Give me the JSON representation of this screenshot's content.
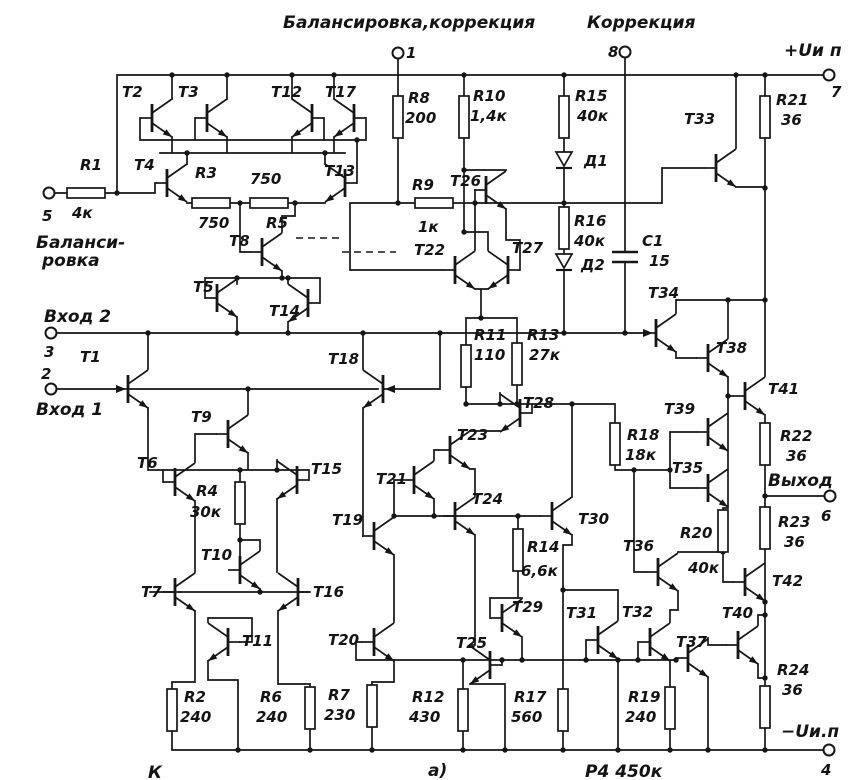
{
  "captions": {
    "left": "К",
    "center": "а)",
    "right": "Р4 450к"
  },
  "terminals": [
    {
      "pin": "1",
      "name": "Балансировка,коррекция",
      "cx": 398,
      "cy": 53,
      "numx": 406,
      "numy": 58,
      "namex": 283,
      "namey": 28
    },
    {
      "pin": "8",
      "name": "Коррекция",
      "cx": 625,
      "cy": 52,
      "numx": 608,
      "numy": 57,
      "namex": 587,
      "namey": 28
    },
    {
      "pin": "7",
      "name": "+Uи п",
      "cx": 829,
      "cy": 75,
      "numx": 831,
      "numy": 97,
      "namex": 784,
      "namey": 56
    },
    {
      "pin": "5",
      "name": "Балансировка",
      "lines": [
        "Баланси-",
        "ровка"
      ],
      "cx": 49,
      "cy": 193,
      "numx": 42,
      "numy": 221,
      "namex": 36,
      "namey": 248,
      "l2x": 42,
      "l2y": 266
    },
    {
      "pin": "3",
      "name": "Вход 2",
      "cx": 51,
      "cy": 333,
      "numx": 44,
      "numy": 357,
      "namex": 44,
      "namey": 322
    },
    {
      "pin": "2",
      "name": "Вход 1",
      "cx": 51,
      "cy": 389,
      "numx": 41,
      "numy": 379,
      "namex": 36,
      "namey": 415
    },
    {
      "pin": "6",
      "name": "Выход",
      "cx": 830,
      "cy": 496,
      "numx": 821,
      "numy": 521,
      "namex": 768,
      "namey": 486
    },
    {
      "pin": "4",
      "name": "−Uи.п",
      "cx": 829,
      "cy": 750,
      "numx": 821,
      "numy": 775,
      "namex": 781,
      "namey": 737
    }
  ],
  "transistors": [
    {
      "name": "T1",
      "x": 128,
      "y": 389,
      "dir": "R",
      "lx": 80,
      "ly": 362
    },
    {
      "name": "T2",
      "x": 152,
      "y": 118,
      "dir": "R",
      "lx": 122,
      "ly": 97
    },
    {
      "name": "T3",
      "x": 207,
      "y": 118,
      "dir": "R",
      "lx": 178,
      "ly": 97
    },
    {
      "name": "T4",
      "x": 167,
      "y": 183,
      "dir": "R",
      "lx": 134,
      "ly": 170
    },
    {
      "name": "T5",
      "x": 217,
      "y": 298,
      "dir": "R",
      "lx": 193,
      "ly": 292
    },
    {
      "name": "T6",
      "x": 175,
      "y": 482,
      "dir": "R",
      "lx": 137,
      "ly": 468
    },
    {
      "name": "T7",
      "x": 175,
      "y": 592,
      "dir": "R",
      "lx": 141,
      "ly": 597
    },
    {
      "name": "T8",
      "x": 262,
      "y": 252,
      "dir": "R",
      "lx": 229,
      "ly": 246
    },
    {
      "name": "T9",
      "x": 228,
      "y": 434,
      "dir": "R",
      "lx": 191,
      "ly": 422
    },
    {
      "name": "T10",
      "x": 240,
      "y": 570,
      "dir": "R",
      "lx": 201,
      "ly": 560
    },
    {
      "name": "T11",
      "x": 228,
      "y": 642,
      "dir": "L",
      "lx": 242,
      "ly": 646
    },
    {
      "name": "T12",
      "x": 312,
      "y": 118,
      "dir": "L",
      "lx": 271,
      "ly": 97
    },
    {
      "name": "T13",
      "x": 345,
      "y": 183,
      "dir": "L",
      "lx": 324,
      "ly": 176
    },
    {
      "name": "T14",
      "x": 308,
      "y": 303,
      "dir": "L",
      "lx": 269,
      "ly": 316
    },
    {
      "name": "T15",
      "x": 297,
      "y": 480,
      "dir": "L",
      "lx": 311,
      "ly": 474
    },
    {
      "name": "T16",
      "x": 298,
      "y": 592,
      "dir": "L",
      "lx": 313,
      "ly": 597
    },
    {
      "name": "T17",
      "x": 354,
      "y": 118,
      "dir": "L",
      "lx": 325,
      "ly": 97
    },
    {
      "name": "T18",
      "x": 383,
      "y": 389,
      "dir": "L",
      "lx": 328,
      "ly": 364
    },
    {
      "name": "T19",
      "x": 374,
      "y": 536,
      "dir": "R",
      "lx": 332,
      "ly": 525
    },
    {
      "name": "T20",
      "x": 374,
      "y": 642,
      "dir": "R",
      "lx": 328,
      "ly": 645
    },
    {
      "name": "T21",
      "x": 414,
      "y": 480,
      "dir": "R",
      "lx": 376,
      "ly": 484
    },
    {
      "name": "T22",
      "x": 455,
      "y": 270,
      "dir": "R",
      "lx": 414,
      "ly": 255
    },
    {
      "name": "T23",
      "x": 450,
      "y": 450,
      "dir": "R",
      "lx": 457,
      "ly": 440
    },
    {
      "name": "T24",
      "x": 455,
      "y": 516,
      "dir": "R",
      "lx": 472,
      "ly": 504
    },
    {
      "name": "T25",
      "x": 490,
      "y": 665,
      "dir": "L",
      "lx": 456,
      "ly": 648
    },
    {
      "name": "T26",
      "x": 486,
      "y": 190,
      "dir": "R",
      "lx": 450,
      "ly": 186
    },
    {
      "name": "T27",
      "x": 508,
      "y": 270,
      "dir": "L",
      "lx": 512,
      "ly": 253
    },
    {
      "name": "T28",
      "x": 520,
      "y": 413,
      "dir": "L",
      "lx": 523,
      "ly": 408
    },
    {
      "name": "T29",
      "x": 502,
      "y": 618,
      "dir": "R",
      "lx": 512,
      "ly": 612
    },
    {
      "name": "T30",
      "x": 552,
      "y": 516,
      "dir": "R",
      "lx": 578,
      "ly": 524
    },
    {
      "name": "T31",
      "x": 598,
      "y": 640,
      "dir": "R",
      "lx": 566,
      "ly": 618
    },
    {
      "name": "T32",
      "x": 650,
      "y": 642,
      "dir": "R",
      "lx": 622,
      "ly": 617
    },
    {
      "name": "T33",
      "x": 716,
      "y": 168,
      "dir": "R",
      "lx": 684,
      "ly": 124
    },
    {
      "name": "T34",
      "x": 656,
      "y": 333,
      "dir": "R",
      "lx": 648,
      "ly": 298
    },
    {
      "name": "T35",
      "x": 708,
      "y": 488,
      "dir": "R",
      "lx": 672,
      "ly": 473
    },
    {
      "name": "T36",
      "x": 658,
      "y": 572,
      "dir": "R",
      "lx": 623,
      "ly": 551
    },
    {
      "name": "T37",
      "x": 688,
      "y": 658,
      "dir": "R",
      "lx": 676,
      "ly": 647
    },
    {
      "name": "T38",
      "x": 708,
      "y": 358,
      "dir": "R",
      "lx": 716,
      "ly": 353
    },
    {
      "name": "T39",
      "x": 708,
      "y": 432,
      "dir": "R",
      "lx": 664,
      "ly": 414
    },
    {
      "name": "T40",
      "x": 738,
      "y": 645,
      "dir": "R",
      "lx": 722,
      "ly": 618
    },
    {
      "name": "T41",
      "x": 745,
      "y": 396,
      "dir": "R",
      "lx": 768,
      "ly": 394
    },
    {
      "name": "T42",
      "x": 745,
      "y": 582,
      "dir": "R",
      "lx": 772,
      "ly": 586
    }
  ],
  "resistors": [
    {
      "name": "R1",
      "value": "4к",
      "x": 86,
      "y": 193,
      "orient": "h",
      "nx": 80,
      "ny": 170,
      "vx": 72,
      "vy": 218
    },
    {
      "name": "R2",
      "value": "240",
      "x": 172,
      "y": 710,
      "orient": "v",
      "nx": 184,
      "ny": 702,
      "vx": 180,
      "vy": 722
    },
    {
      "name": "R3",
      "value": "750",
      "x": 211,
      "y": 203,
      "orient": "h",
      "nx": 195,
      "ny": 178,
      "vx": 198,
      "vy": 228
    },
    {
      "name": "R4",
      "value": "30к",
      "x": 240,
      "y": 503,
      "orient": "v",
      "nx": 196,
      "ny": 496,
      "vx": 190,
      "vy": 517
    },
    {
      "name": "R5",
      "value": "750",
      "x": 269,
      "y": 203,
      "orient": "h",
      "nx": 266,
      "ny": 228,
      "vx": 250,
      "vy": 184
    },
    {
      "name": "R6",
      "value": "240",
      "x": 310,
      "y": 708,
      "orient": "v",
      "nx": 260,
      "ny": 702,
      "vx": 256,
      "vy": 722
    },
    {
      "name": "R7",
      "value": "230",
      "x": 372,
      "y": 706,
      "orient": "v",
      "nx": 328,
      "ny": 700,
      "vx": 324,
      "vy": 720
    },
    {
      "name": "R8",
      "value": "200",
      "x": 398,
      "y": 117,
      "orient": "v",
      "nx": 408,
      "ny": 103,
      "vx": 405,
      "vy": 123
    },
    {
      "name": "R9",
      "value": "1к",
      "x": 434,
      "y": 203,
      "orient": "h",
      "nx": 412,
      "ny": 190,
      "vx": 418,
      "vy": 232
    },
    {
      "name": "R10",
      "value": "1,4к",
      "x": 464,
      "y": 117,
      "orient": "v",
      "nx": 473,
      "ny": 101,
      "vx": 470,
      "vy": 121
    },
    {
      "name": "R11",
      "value": "110",
      "x": 466,
      "y": 366,
      "orient": "v",
      "nx": 474,
      "ny": 340,
      "vx": 474,
      "vy": 360
    },
    {
      "name": "R12",
      "value": "430",
      "x": 463,
      "y": 710,
      "orient": "v",
      "nx": 412,
      "ny": 702,
      "vx": 409,
      "vy": 722
    },
    {
      "name": "R13",
      "value": "27к",
      "x": 517,
      "y": 364,
      "orient": "v",
      "nx": 527,
      "ny": 340,
      "vx": 529,
      "vy": 360
    },
    {
      "name": "R14",
      "value": "6,6к",
      "x": 518,
      "y": 550,
      "orient": "v",
      "nx": 527,
      "ny": 552,
      "vx": 521,
      "vy": 576
    },
    {
      "name": "R15",
      "value": "40к",
      "x": 564,
      "y": 117,
      "orient": "v",
      "nx": 575,
      "ny": 101,
      "vx": 577,
      "vy": 121
    },
    {
      "name": "R16",
      "value": "40к",
      "x": 564,
      "y": 228,
      "orient": "v",
      "nx": 574,
      "ny": 226,
      "vx": 574,
      "vy": 246
    },
    {
      "name": "R17",
      "value": "560",
      "x": 563,
      "y": 710,
      "orient": "v",
      "nx": 514,
      "ny": 702,
      "vx": 511,
      "vy": 722
    },
    {
      "name": "R18",
      "value": "18к",
      "x": 615,
      "y": 444,
      "orient": "v",
      "nx": 627,
      "ny": 440,
      "vx": 625,
      "vy": 460
    },
    {
      "name": "R19",
      "value": "240",
      "x": 670,
      "y": 708,
      "orient": "v",
      "nx": 628,
      "ny": 702,
      "vx": 625,
      "vy": 722
    },
    {
      "name": "R20",
      "value": "40к",
      "x": 723,
      "y": 531,
      "orient": "v",
      "nx": 680,
      "ny": 538,
      "vx": 688,
      "vy": 573
    },
    {
      "name": "R21",
      "value": "36",
      "x": 765,
      "y": 117,
      "orient": "v",
      "nx": 776,
      "ny": 105,
      "vx": 781,
      "vy": 125
    },
    {
      "name": "R22",
      "value": "36",
      "x": 765,
      "y": 444,
      "orient": "v",
      "nx": 780,
      "ny": 441,
      "vx": 786,
      "vy": 461
    },
    {
      "name": "R23",
      "value": "36",
      "x": 765,
      "y": 528,
      "orient": "v",
      "nx": 778,
      "ny": 527,
      "vx": 784,
      "vy": 547
    },
    {
      "name": "R24",
      "value": "36",
      "x": 765,
      "y": 707,
      "orient": "v",
      "nx": 777,
      "ny": 675,
      "vx": 782,
      "vy": 695
    }
  ],
  "diodes": [
    {
      "name": "Д1",
      "x": 564,
      "y": 152,
      "lx": 584,
      "ly": 166
    },
    {
      "name": "Д2",
      "x": 564,
      "y": 254,
      "lx": 581,
      "ly": 270
    }
  ],
  "capacitors": [
    {
      "name": "C1",
      "value": "15",
      "x": 625,
      "y": 257,
      "nx": 642,
      "ny": 246,
      "vx": 649,
      "vy": 266
    }
  ]
}
